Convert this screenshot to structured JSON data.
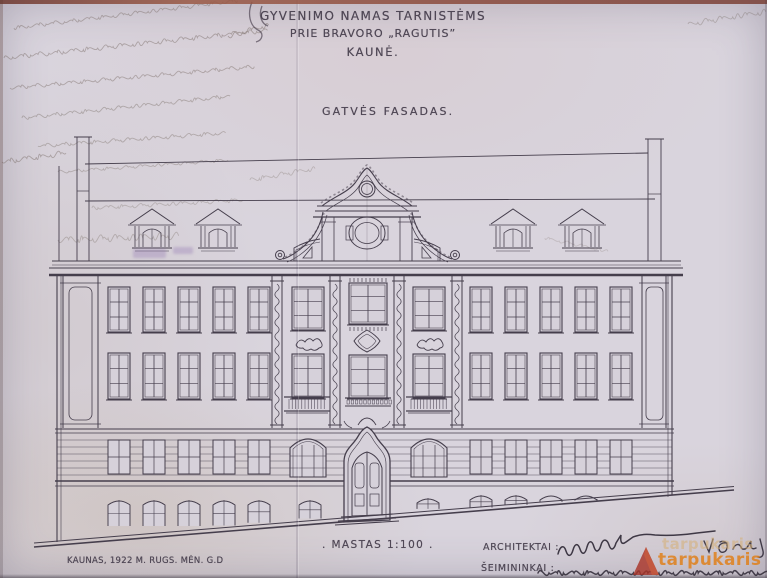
{
  "titles": {
    "line1": "GYVENIMO NAMAS TARNISTĖMS",
    "line2": "PRIE BRAVORO „RAGUTIS”",
    "line3": "KAUNĖ."
  },
  "drawing": {
    "label": "GATVĖS FASADAS.",
    "scale_label": ". MASTAS 1:100 .",
    "place_date": "KAUNAS, 1922 M. RUGS. MĖN. G.D"
  },
  "signature_block": {
    "architects_label": "ARCHITEKTAI :",
    "owners_label": "ŠEIMININKAI :"
  },
  "watermark": {
    "text": "tarpukaris"
  },
  "colors": {
    "paper": "#d4cfd8",
    "ink": "#453e4c",
    "text_ink": "#3e3645",
    "watermark_text": "#e0811c",
    "watermark_mark": "#a83428"
  }
}
